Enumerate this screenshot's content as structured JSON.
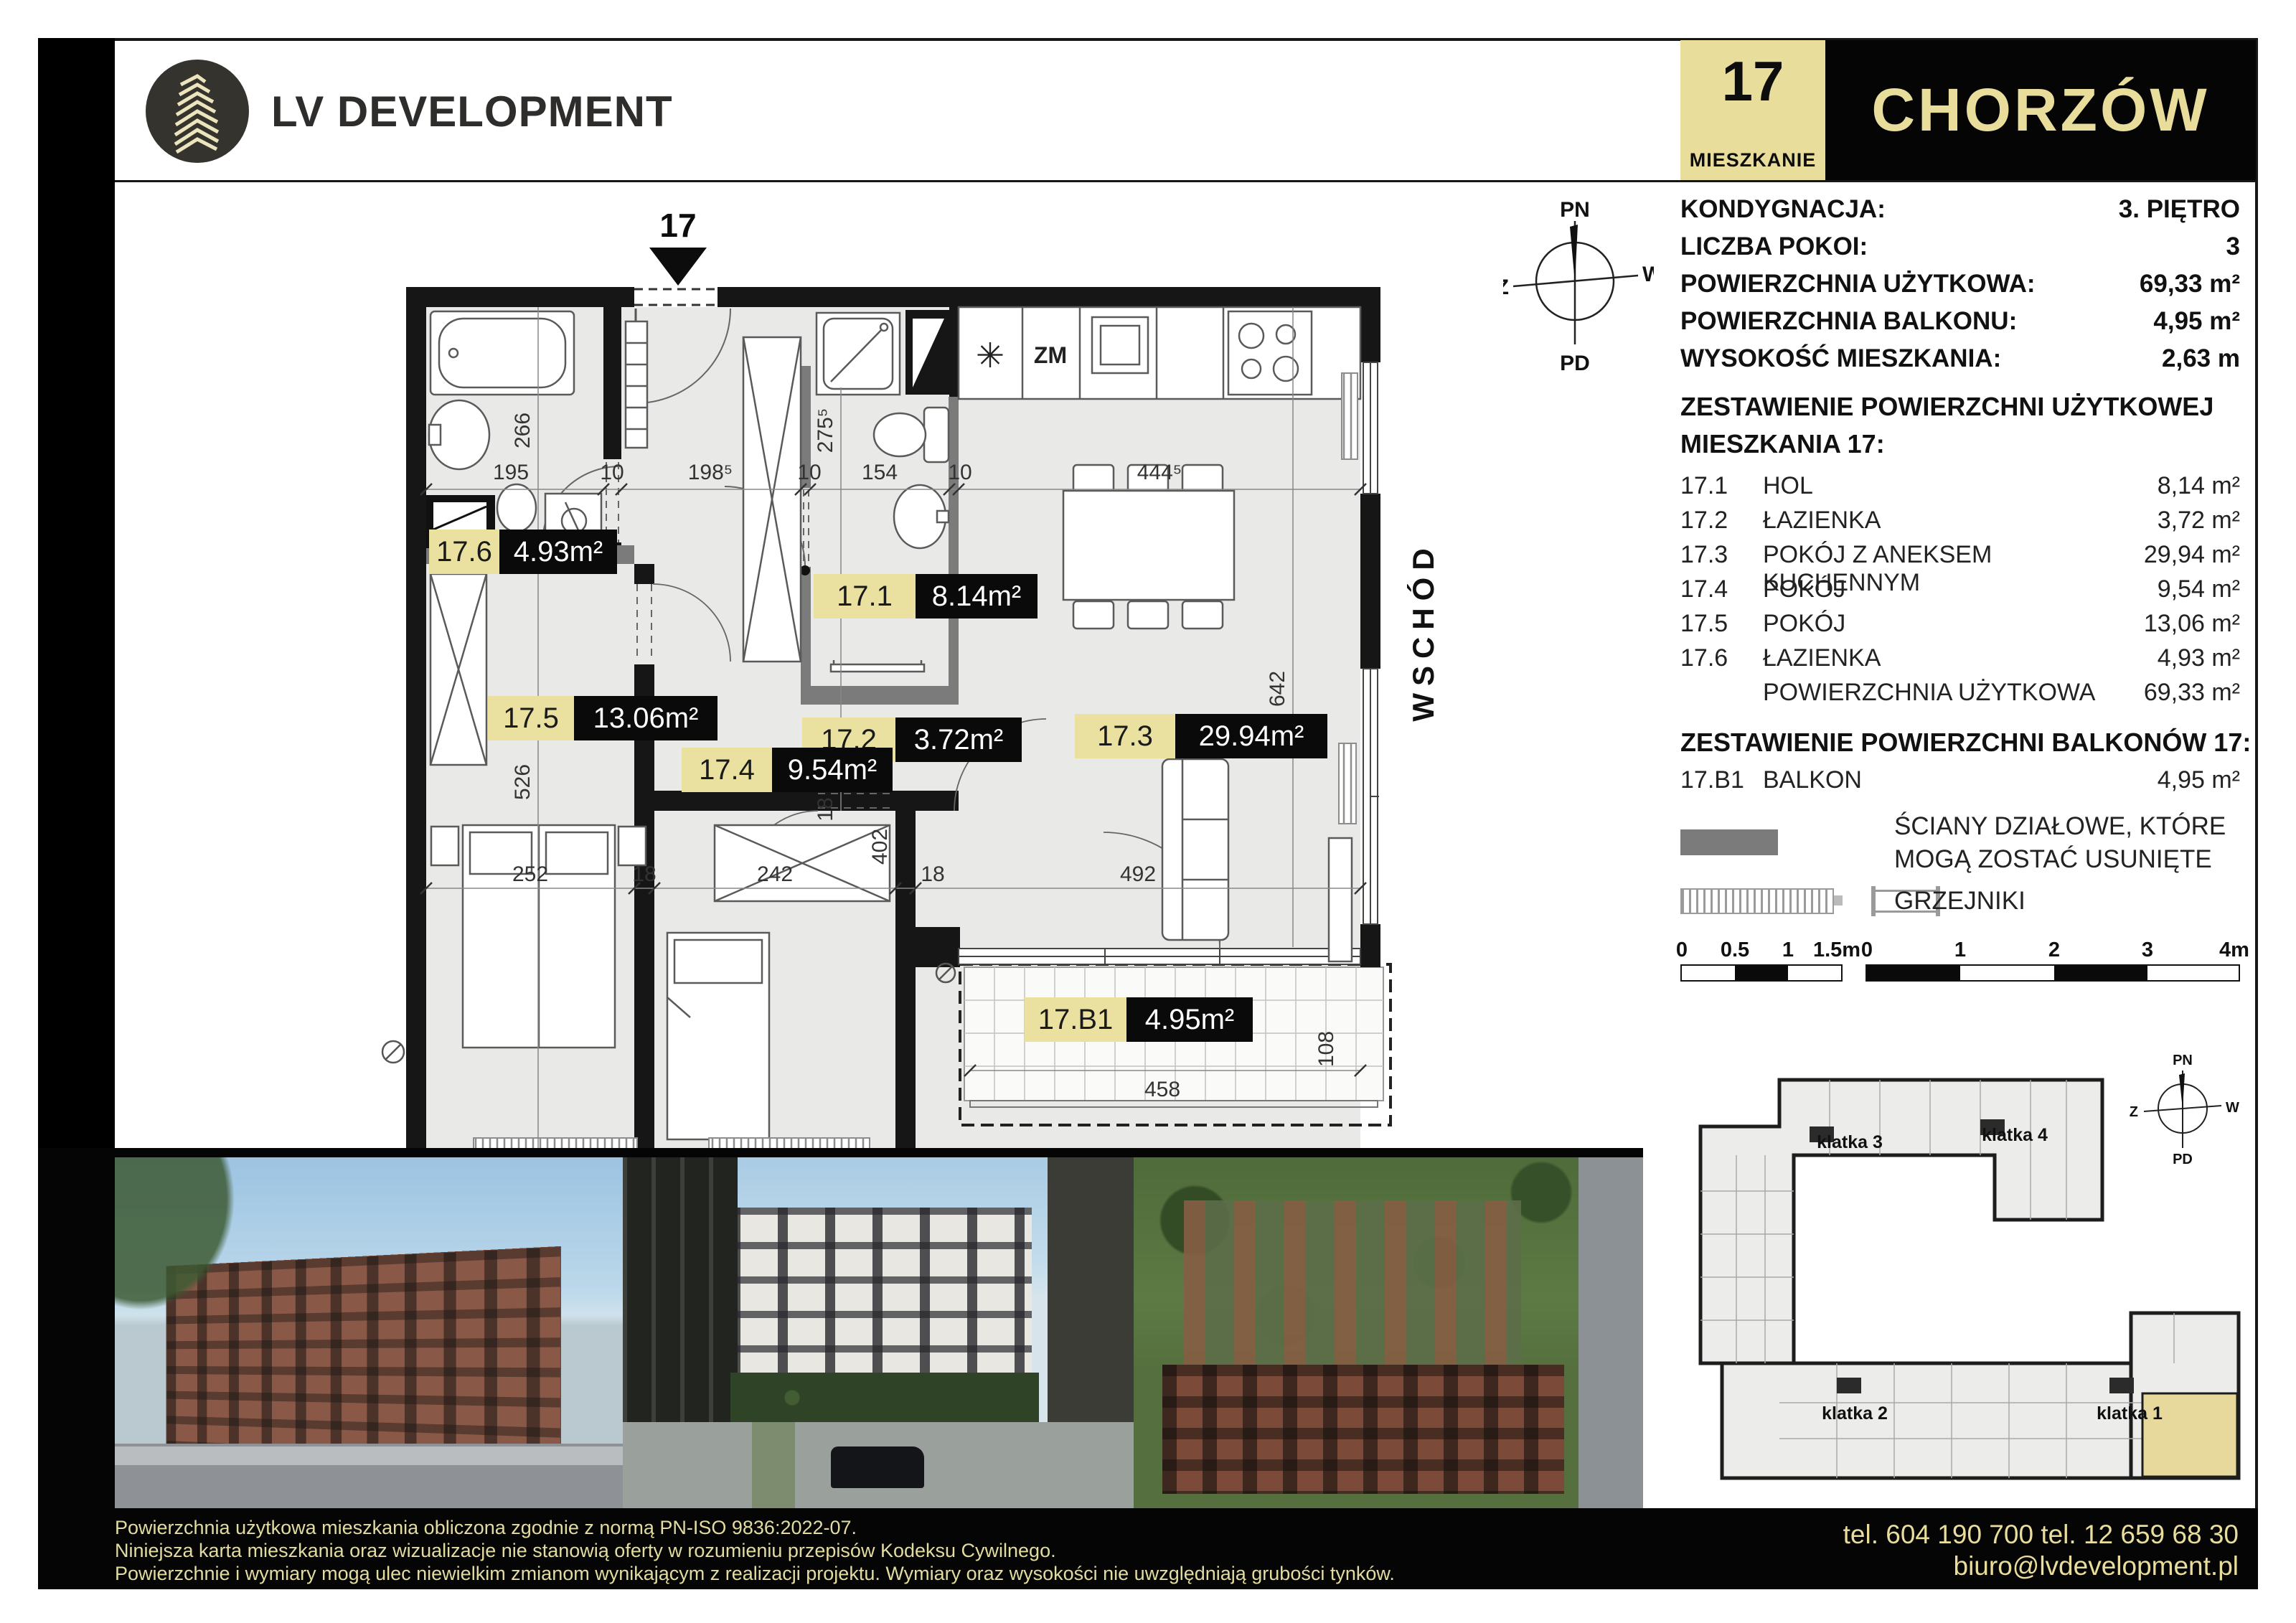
{
  "header": {
    "brand": "LV DEVELOPMENT",
    "unit_number": "17",
    "unit_caption": "MIESZKANIE",
    "city": "CHORZÓW",
    "accent_color": "#e8dd9b",
    "black": "#050505"
  },
  "info": {
    "rows": [
      {
        "label": "KONDYGNACJA:",
        "value": "3. PIĘTRO"
      },
      {
        "label": "LICZBA POKOI:",
        "value": "3"
      },
      {
        "label": "POWIERZCHNIA UŻYTKOWA:",
        "value": "69,33 m²"
      },
      {
        "label": "POWIERZCHNIA BALKONU:",
        "value": "4,95 m²"
      },
      {
        "label": "WYSOKOŚĆ MIESZKANIA:",
        "value": "2,63 m"
      }
    ]
  },
  "areas": {
    "heading_line1": "ZESTAWIENIE POWIERZCHNI UŻYTKOWEJ",
    "heading_line2": "MIESZKANIA 17:",
    "rows": [
      {
        "id": "17.1",
        "name": "HOL",
        "value": "8,14 m²"
      },
      {
        "id": "17.2",
        "name": "ŁAZIENKA",
        "value": "3,72 m²"
      },
      {
        "id": "17.3",
        "name": "POKÓJ Z ANEKSEM KUCHENNYM",
        "value": "29,94 m²"
      },
      {
        "id": "17.4",
        "name": "POKÓJ",
        "value": "9,54 m²"
      },
      {
        "id": "17.5",
        "name": "POKÓJ",
        "value": "13,06 m²"
      },
      {
        "id": "17.6",
        "name": "ŁAZIENKA",
        "value": "4,93 m²"
      },
      {
        "id": "",
        "name": "POWIERZCHNIA UŻYTKOWA",
        "value": "69,33 m²"
      }
    ],
    "balcony_heading": "ZESTAWIENIE POWIERZCHNI BALKONÓW 17:",
    "balcony_row": {
      "id": "17.B1",
      "name": "BALKON",
      "value": "4,95 m²"
    }
  },
  "legend": {
    "walls_line1": "ŚCIANY DZIAŁOWE, KTÓRE",
    "walls_line2": "MOGĄ ZOSTAĆ USUNIĘTE",
    "radiators": "GRZEJNIKI",
    "wall_swatch_color": "#7b7b7b"
  },
  "scales": {
    "small": {
      "labels": [
        "0",
        "0.5",
        "1",
        "1.5m"
      ]
    },
    "large": {
      "labels": [
        "0",
        "1",
        "2",
        "3",
        "4m"
      ]
    }
  },
  "plan": {
    "entrance_label": "17",
    "east_label": "WSCHÓD",
    "south_label": "POŁUDNIE",
    "kitchen_dishwasher": "ZM",
    "kitchen_aster": "✳",
    "rooms": [
      {
        "id": "17.6",
        "area": "4.93m²"
      },
      {
        "id": "17.1",
        "area": "8.14m²"
      },
      {
        "id": "17.2",
        "area": "3.72m²"
      },
      {
        "id": "17.5",
        "area": "13.06m²"
      },
      {
        "id": "17.4",
        "area": "9.54m²"
      },
      {
        "id": "17.3",
        "area": "29.94m²"
      },
      {
        "id": "17.B1",
        "area": "4.95m²"
      }
    ],
    "dims_top": [
      "195",
      "10",
      "198⁵",
      "10",
      "154",
      "10",
      "444⁵"
    ],
    "dims_bottom": [
      "252",
      "18",
      "242",
      "18",
      "492"
    ],
    "dim_266": "266",
    "dim_275": "275⁵",
    "dim_96": "96⁵",
    "dim_10": "10",
    "dim_642": "642",
    "dim_526": "526",
    "dim_402": "402",
    "dim_18": "18",
    "dim_458": "458",
    "dim_108": "108",
    "label_bg": "#eae0a0"
  },
  "compass": {
    "n": "PN",
    "s": "PD",
    "e": "W",
    "w": "Z"
  },
  "site_plan": {
    "klatka1": "klatka 1",
    "klatka2": "klatka 2",
    "klatka3": "klatka 3",
    "klatka4": "klatka 4",
    "highlight_color": "#e6d99b"
  },
  "footer": {
    "disclaimer": [
      "Powierzchnia użytkowa mieszkania obliczona zgodnie z normą PN-ISO 9836:2022-07.",
      "Niniejsza karta mieszkania oraz wizualizacje nie stanowią oferty w rozumieniu przepisów Kodeksu Cywilnego.",
      "Powierzchnie i wymiary mogą ulec niewielkim zmianom wynikającym z realizacji projektu. Wymiary oraz wysokości nie uwzględniają grubości tynków."
    ],
    "phones": "tel. 604 190 700   tel. 12 659 68 30",
    "email": "biuro@lvdevelopment.pl"
  }
}
